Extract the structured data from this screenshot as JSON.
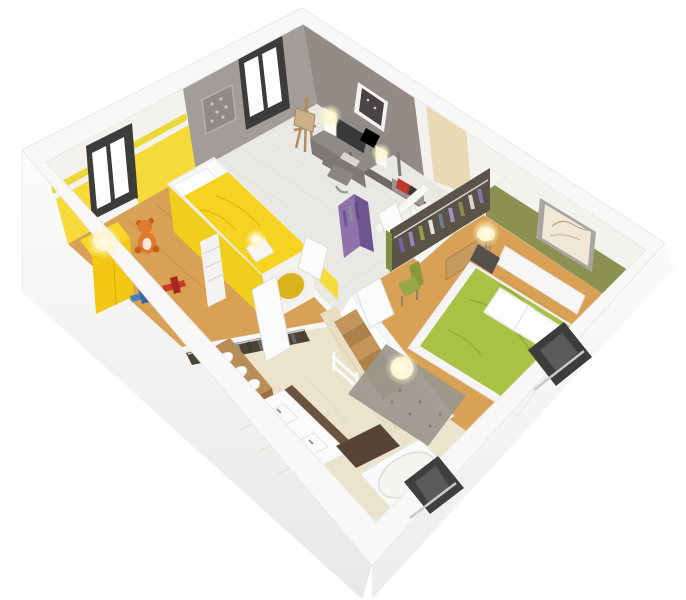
{
  "scene": {
    "description": "isometric-3d-floor-plan-cutaway-render-upper-floor",
    "palette": {
      "background": "#ffffff",
      "wallBand": "#f9f8f6",
      "outerFaceTop": "#ffffff",
      "outerFaceBottom": "#e9e8e6",
      "whiteWall": "#f3f2ef",
      "grayWall": "#a39d9a",
      "taupeWall": "#948b87",
      "kidsYellowWall": "#f6da3a",
      "kidsStripe": "#ecd83a",
      "kidsFurnitureYellow": "#f2c814",
      "duvetYellow": "#f7d321",
      "woodFloor": "#d9a155",
      "woodPlankLine": "#c08c44",
      "laminateFloor": "#eae8e4",
      "tileFloor": "#f1efec",
      "bathTileFloor": "#ece3cd",
      "bathWallTile": "#e8dec5",
      "oliveWall": "#8b9150",
      "duvetGreen": "#a9c145",
      "windowFrameDark": "#3c3c3a",
      "windowPaneWhite": "#fdfdfc",
      "purpleCloset": "#8f72ab",
      "purpleClosetDark": "#6f5590",
      "stairWood": "#c3955b",
      "stairWoodDark": "#ad8149",
      "counterWood": "#b98d58",
      "counterWoodDark": "#97713f",
      "matBrown": "#564437",
      "rugGray": "#9c968e",
      "wardrobeWood": "#c79b5f",
      "darkPartition": "#6e6866",
      "deskGray": "#8f8a87",
      "monitorDark": "#3a3938",
      "bookRed": "#c0392b",
      "teddyOrange": "#e07a2e",
      "planeBlue": "#4a7fc1",
      "planeRed": "#c93a2b",
      "chairGreen": "#97a647",
      "easelWood": "#b08c5e",
      "closetPanelDark": "#4e4136",
      "fixtureWhite": "#fbfbf9",
      "glowWarm": "#fff3c4"
    },
    "clothesColors": {
      "kidsCloset": [
        "#3f4a3e",
        "#5a6355",
        "#707a6b",
        "#4a5568",
        "#8b92a5",
        "#3a3f36",
        "#5f6b5e",
        "#766f63",
        "#4d574d",
        "#606a72"
      ],
      "bedroomWardrobe": [
        "#7b5ea6",
        "#9b86bb",
        "#8fa050",
        "#e8e6e2",
        "#6d7f8a",
        "#a58fc0",
        "#7e9050",
        "#d8d5d0",
        "#8a74ae"
      ],
      "purpleCloset": [
        "#6d5590",
        "#8a8f98",
        "#5d4a7e"
      ]
    },
    "rooms": [
      {
        "id": "kids-bedroom",
        "floor": "wood",
        "features": [
          "window",
          "accent-stripe",
          "loft-bed",
          "ladder",
          "play-hole",
          "cabinet-lamp",
          "nightstand-lamp",
          "teddy-bear",
          "toy-plane-blue",
          "toy-plane-red"
        ]
      },
      {
        "id": "office-studio",
        "floor": "laminate",
        "features": [
          "window",
          "filigree-art",
          "framed-art",
          "desk",
          "monitor",
          "keyboard",
          "cube-lamps",
          "chair",
          "easel",
          "shelf-books",
          "stool"
        ]
      },
      {
        "id": "wc",
        "floor": "tile",
        "features": [
          "toilet",
          "toilet-paper",
          "beige-stripe-wall",
          "door"
        ]
      },
      {
        "id": "hallway-landing",
        "floor": "tile",
        "features": [
          "staircase",
          "railing",
          "purple-closet",
          "doors"
        ]
      },
      {
        "id": "bathroom",
        "floor": "beige-tile",
        "features": [
          "open-closet-clothes",
          "wood-counter",
          "vessel-sinks",
          "double-vanity",
          "taps",
          "bath-mats",
          "bathtub",
          "door"
        ]
      },
      {
        "id": "master-bedroom",
        "floor": "wood",
        "features": [
          "olive-accent-wall",
          "framed-sketch",
          "sliding-wardrobe",
          "hanging-clothes",
          "green-chair",
          "double-bed",
          "green-duvet",
          "pillows",
          "headboard",
          "nightstand-lamp",
          "rug",
          "ball-floor-lamp",
          "door"
        ]
      }
    ],
    "exterior": [
      "facade-window-bedroom",
      "facade-window-bathroom"
    ]
  }
}
